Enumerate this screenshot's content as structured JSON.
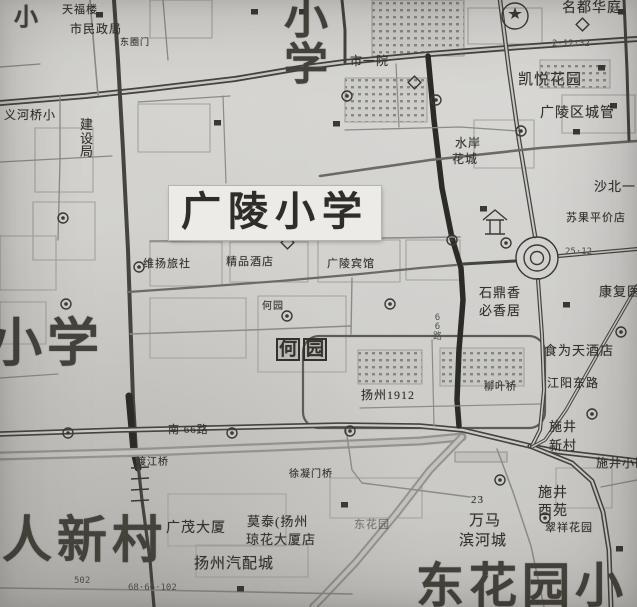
{
  "map": {
    "paper_color": "#d2d1cd",
    "ink_color": "#3b3a36",
    "labels": [
      {
        "text": "小学",
        "x": 284,
        "y": -4,
        "size": 44,
        "kind": "giant",
        "vertical": true
      },
      {
        "text": "广陵小学",
        "x": 169,
        "y": 186,
        "size": 40,
        "kind": "plate"
      },
      {
        "text": "小学",
        "x": -10,
        "y": 318,
        "size": 52,
        "kind": "giant"
      },
      {
        "text": "人新村",
        "x": 2,
        "y": 514,
        "size": 50,
        "kind": "giant"
      },
      {
        "text": "东花园小",
        "x": 416,
        "y": 562,
        "size": 48,
        "kind": "giant"
      },
      {
        "text": "小",
        "x": 14,
        "y": 6,
        "size": 24,
        "kind": "giant"
      },
      {
        "text": "天福楼",
        "x": 62,
        "y": 5,
        "size": 11
      },
      {
        "text": "市民政局",
        "x": 70,
        "y": 23,
        "size": 12
      },
      {
        "text": "东圈门",
        "x": 120,
        "y": 38,
        "size": 9
      },
      {
        "text": "市一院",
        "x": 350,
        "y": 55,
        "size": 12
      },
      {
        "text": "名都华庭",
        "x": 562,
        "y": 2,
        "size": 14
      },
      {
        "text": "凯悦花园",
        "x": 518,
        "y": 73,
        "size": 15
      },
      {
        "text": "广陵区城管",
        "x": 540,
        "y": 107,
        "size": 14
      },
      {
        "text": "水岸",
        "x": 455,
        "y": 137,
        "size": 12
      },
      {
        "text": "花城",
        "x": 452,
        "y": 153,
        "size": 12
      },
      {
        "text": "沙北一",
        "x": 594,
        "y": 180,
        "size": 13
      },
      {
        "text": "苏果平价店",
        "x": 566,
        "y": 213,
        "size": 11
      },
      {
        "text": "康复医院",
        "x": 599,
        "y": 285,
        "size": 13
      },
      {
        "text": "石鼎香",
        "x": 479,
        "y": 286,
        "size": 13
      },
      {
        "text": "必香居",
        "x": 479,
        "y": 304,
        "size": 13
      },
      {
        "text": "食为天酒店",
        "x": 544,
        "y": 344,
        "size": 13
      },
      {
        "text": "江阳东路",
        "x": 547,
        "y": 377,
        "size": 12
      },
      {
        "text": "柳叶桥",
        "x": 484,
        "y": 383,
        "size": 10
      },
      {
        "text": "施井",
        "x": 549,
        "y": 420,
        "size": 13
      },
      {
        "text": "新村",
        "x": 549,
        "y": 439,
        "size": 13
      },
      {
        "text": "施井小区",
        "x": 596,
        "y": 457,
        "size": 12
      },
      {
        "text": "施井",
        "x": 538,
        "y": 487,
        "size": 14
      },
      {
        "text": "西苑",
        "x": 538,
        "y": 505,
        "size": 14
      },
      {
        "text": "翠祥花园",
        "x": 545,
        "y": 523,
        "size": 11
      },
      {
        "text": "23",
        "x": 471,
        "y": 495,
        "size": 11
      },
      {
        "text": "万马",
        "x": 469,
        "y": 514,
        "size": 15
      },
      {
        "text": "滨河城",
        "x": 459,
        "y": 534,
        "size": 15
      },
      {
        "text": "东花园",
        "x": 354,
        "y": 520,
        "size": 11,
        "kind": "faint"
      },
      {
        "text": "广茂大厦",
        "x": 166,
        "y": 522,
        "size": 14
      },
      {
        "text": "莫泰(扬州",
        "x": 247,
        "y": 515,
        "size": 13
      },
      {
        "text": "琼花大厦店",
        "x": 246,
        "y": 533,
        "size": 13
      },
      {
        "text": "扬州汽配城",
        "x": 194,
        "y": 557,
        "size": 15
      },
      {
        "text": "渡江桥",
        "x": 136,
        "y": 458,
        "size": 10
      },
      {
        "text": "徐凝门桥",
        "x": 289,
        "y": 470,
        "size": 10
      },
      {
        "text": "南 66路",
        "x": 168,
        "y": 425,
        "size": 11
      },
      {
        "text": "扬州1912",
        "x": 361,
        "y": 389,
        "size": 12
      },
      {
        "text": "何园",
        "x": 276,
        "y": 338,
        "size": 18,
        "kind": "scenic"
      },
      {
        "text": "何园",
        "x": 262,
        "y": 302,
        "size": 10
      },
      {
        "text": "维扬旅社",
        "x": 143,
        "y": 259,
        "size": 11
      },
      {
        "text": "精品酒店",
        "x": 226,
        "y": 257,
        "size": 11
      },
      {
        "text": "广陵宾馆",
        "x": 327,
        "y": 259,
        "size": 11
      },
      {
        "text": "建设局",
        "x": 80,
        "y": 118,
        "size": 13,
        "vertical": true
      },
      {
        "text": "义河桥小",
        "x": 4,
        "y": 109,
        "size": 12
      },
      {
        "text": "25·12",
        "x": 565,
        "y": 248,
        "size": 9,
        "kind": "route"
      },
      {
        "text": "2·12·32",
        "x": 552,
        "y": 40,
        "size": 9,
        "kind": "route"
      },
      {
        "text": "66路",
        "x": 433,
        "y": 314,
        "size": 9,
        "kind": "route",
        "vertical": true
      },
      {
        "text": "68·66·102",
        "x": 128,
        "y": 584,
        "size": 9,
        "kind": "route"
      },
      {
        "text": "502",
        "x": 74,
        "y": 577,
        "size": 9,
        "kind": "route"
      }
    ],
    "roads": [
      {
        "d": "M0,103 L85,96 L150,89 L235,79 L300,68 L345,62 L430,54 L520,47 L637,39",
        "w": 6,
        "s": "dark"
      },
      {
        "d": "M0,103 L85,96 L150,89 L235,79 L300,68 L345,62 L430,54 L520,47 L637,39",
        "w": 2.4,
        "s": "lane"
      },
      {
        "d": "M114,0 L118,60 L123,150 L128,250 L131,340 L133,400 L136,452",
        "w": 4,
        "s": "dark"
      },
      {
        "d": "M129,396 L134,452 L138,468",
        "w": 7,
        "s": "heavy"
      },
      {
        "d": "M137,455 L142,500 L150,560 L154,607",
        "w": 3.2,
        "s": "dark"
      },
      {
        "d": "M0,456 L150,452 L300,446 L420,441 L462,437",
        "w": 9,
        "s": "canal"
      },
      {
        "d": "M0,456 L150,452 L300,446 L420,441 L462,437",
        "w": 4.5,
        "s": "canal2"
      },
      {
        "d": "M0,434 L120,430 L250,427 L340,425 L420,426 L463,430 L530,446 L560,452 L612,458 L637,461",
        "w": 5.5,
        "s": "dark"
      },
      {
        "d": "M0,434 L120,430 L250,427 L340,425 L420,426 L463,430 L530,446 L560,452 L612,458 L637,461",
        "w": 2.2,
        "s": "lane"
      },
      {
        "d": "M530,446 L572,463 L592,481 L603,512 L609,550 L611,607",
        "w": 5,
        "s": "dark"
      },
      {
        "d": "M530,446 L572,463 L592,481 L603,512 L609,550 L611,607",
        "w": 2,
        "s": "lane"
      },
      {
        "d": "M462,437 L430,470 L396,514 L356,562 L322,598 L313,607",
        "w": 8,
        "s": "canal"
      },
      {
        "d": "M462,437 L430,470 L396,514 L356,562 L322,598 L313,607",
        "w": 4,
        "s": "canal2"
      },
      {
        "d": "M497,449 L513,492 L531,546 L544,607",
        "w": 1.5,
        "s": "min"
      },
      {
        "d": "M428,56 L434,120 L442,188 L452,238 L461,268 L463,300 L459,350 L457,400 L459,426",
        "w": 5.5,
        "s": "heavy"
      },
      {
        "d": "M128,292 L200,287 L280,281 L360,274 L420,268 L456,265",
        "w": 2.2,
        "s": "med"
      },
      {
        "d": "M463,264 L515,261",
        "w": 3,
        "s": "dark"
      },
      {
        "d": "M559,256 L637,249",
        "w": 4,
        "s": "dark"
      },
      {
        "d": "M559,256 L637,249",
        "w": 1.6,
        "s": "lane"
      },
      {
        "d": "M500,0 L509,70 L519,140 L529,200 L535,236",
        "w": 4.5,
        "s": "dark"
      },
      {
        "d": "M500,0 L509,70 L519,140 L529,200 L535,236",
        "w": 2,
        "s": "lane"
      },
      {
        "d": "M538,280 L542,335 L544,390 L540,430 L532,446",
        "w": 4,
        "s": "dark"
      },
      {
        "d": "M538,280 L542,335 L544,390 L540,430 L532,446",
        "w": 1.6,
        "s": "lane"
      },
      {
        "d": "M637,286 L600,350 L566,410 L545,440 L532,447",
        "w": 3.5,
        "s": "dark"
      },
      {
        "d": "M637,286 L600,350 L566,410 L545,440 L532,447",
        "w": 1.5,
        "s": "lane"
      },
      {
        "d": "M320,176 L430,160 L540,148 L637,141",
        "w": 2.6,
        "s": "med"
      },
      {
        "d": "M624,0 L627,70 L629,140",
        "w": 3,
        "s": "dark"
      },
      {
        "d": "M342,0 L345,30 L345,62",
        "w": 3,
        "s": "dark"
      },
      {
        "d": "M60,95 L60,160 L58,240",
        "w": 1.3,
        "s": "min"
      },
      {
        "d": "M0,162 L112,156",
        "w": 1.3,
        "s": "min"
      },
      {
        "d": "M138,102 L230,96",
        "w": 1.3,
        "s": "min"
      },
      {
        "d": "M150,241 L460,237",
        "w": 1.6,
        "s": "min"
      },
      {
        "d": "M345,130 L460,127 L518,131",
        "w": 1.3,
        "s": "min"
      },
      {
        "d": "M396,64 L399,127",
        "w": 1.2,
        "s": "min"
      },
      {
        "d": "M223,96 L226,183",
        "w": 1.2,
        "s": "min"
      },
      {
        "d": "M130,334 L250,330 L351,326",
        "w": 1.5,
        "s": "min"
      },
      {
        "d": "M352,278 L351,334",
        "w": 1.4,
        "s": "min"
      },
      {
        "d": "M0,378 L58,374",
        "w": 1.2,
        "s": "min"
      },
      {
        "d": "M0,588 L150,590 L352,594",
        "w": 1.6,
        "s": "min"
      },
      {
        "d": "M346,429 L352,470 L362,483 L432,492 L470,497",
        "w": 1.4,
        "s": "min"
      },
      {
        "d": "M90,0 L95,60 L98,95",
        "w": 1.6,
        "s": "min"
      },
      {
        "d": "M163,0 L168,60",
        "w": 1.3,
        "s": "min"
      },
      {
        "d": "M0,67 L40,64",
        "w": 1.2,
        "s": "min"
      },
      {
        "d": "M601,487 L637,480",
        "w": 1.4,
        "s": "min"
      },
      {
        "d": "M360,408 L540,404",
        "w": 1.2,
        "s": "min"
      },
      {
        "d": "M432,340 L434,426",
        "w": 1.2,
        "s": "min"
      }
    ],
    "blocks": [
      {
        "x": 35,
        "y": 128,
        "w": 58,
        "h": 64
      },
      {
        "x": 33,
        "y": 202,
        "w": 62,
        "h": 58
      },
      {
        "x": 0,
        "y": 236,
        "w": 56,
        "h": 54
      },
      {
        "x": 138,
        "y": 104,
        "w": 72,
        "h": 48
      },
      {
        "x": 150,
        "y": 0,
        "w": 62,
        "h": 38
      },
      {
        "x": 372,
        "y": 0,
        "w": 92,
        "h": 56,
        "f": "dots"
      },
      {
        "x": 468,
        "y": 8,
        "w": 74,
        "h": 36
      },
      {
        "x": 345,
        "y": 78,
        "w": 82,
        "h": 44,
        "f": "dots"
      },
      {
        "x": 562,
        "y": 95,
        "w": 73,
        "h": 38
      },
      {
        "x": 150,
        "y": 242,
        "w": 72,
        "h": 44
      },
      {
        "x": 230,
        "y": 242,
        "w": 78,
        "h": 40
      },
      {
        "x": 318,
        "y": 240,
        "w": 82,
        "h": 42
      },
      {
        "x": 406,
        "y": 240,
        "w": 54,
        "h": 40
      },
      {
        "x": 258,
        "y": 296,
        "w": 88,
        "h": 76
      },
      {
        "x": 150,
        "y": 298,
        "w": 96,
        "h": 60
      },
      {
        "x": 0,
        "y": 302,
        "w": 46,
        "h": 42
      },
      {
        "x": 303,
        "y": 336,
        "w": 242,
        "h": 92,
        "rx": 16,
        "f": "loop"
      },
      {
        "x": 358,
        "y": 350,
        "w": 64,
        "h": 34,
        "f": "dots"
      },
      {
        "x": 440,
        "y": 348,
        "w": 84,
        "h": 38,
        "f": "dots"
      },
      {
        "x": 168,
        "y": 494,
        "w": 118,
        "h": 52
      },
      {
        "x": 330,
        "y": 478,
        "w": 92,
        "h": 40
      },
      {
        "x": 556,
        "y": 468,
        "w": 56,
        "h": 40
      },
      {
        "x": 196,
        "y": 545,
        "w": 112,
        "h": 32
      },
      {
        "x": 474,
        "y": 120,
        "w": 60,
        "h": 48
      },
      {
        "x": 540,
        "y": 60,
        "w": 70,
        "h": 28,
        "f": "dots"
      },
      {
        "x": 455,
        "y": 452,
        "w": 52,
        "h": 10,
        "f": "shade"
      }
    ],
    "icons": [
      {
        "type": "roundabout",
        "x": 537,
        "y": 258
      },
      {
        "type": "pavilion",
        "x": 483,
        "y": 210
      },
      {
        "type": "emblem",
        "x": 502,
        "y": 3
      },
      {
        "type": "bridge",
        "x": 133,
        "y": 468
      },
      {
        "type": "bus-stop",
        "x": 63,
        "y": 218
      },
      {
        "type": "bus-stop",
        "x": 303,
        "y": 214
      },
      {
        "type": "bus-stop",
        "x": 139,
        "y": 267
      },
      {
        "type": "bus-stop",
        "x": 66,
        "y": 304
      },
      {
        "type": "bus-stop",
        "x": 390,
        "y": 304
      },
      {
        "type": "bus-stop",
        "x": 347,
        "y": 96
      },
      {
        "type": "bus-stop",
        "x": 521,
        "y": 131
      },
      {
        "type": "bus-stop",
        "x": 452,
        "y": 240
      },
      {
        "type": "bus-stop",
        "x": 506,
        "y": 243
      },
      {
        "type": "bus-stop",
        "x": 350,
        "y": 431
      },
      {
        "type": "bus-stop",
        "x": 232,
        "y": 433
      },
      {
        "type": "bus-stop",
        "x": 68,
        "y": 433
      },
      {
        "type": "bus-stop",
        "x": 500,
        "y": 480
      },
      {
        "type": "bus-stop",
        "x": 592,
        "y": 414
      },
      {
        "type": "bus-stop",
        "x": 621,
        "y": 332
      },
      {
        "type": "bus-stop",
        "x": 436,
        "y": 100
      },
      {
        "type": "bus-stop",
        "x": 287,
        "y": 316
      },
      {
        "type": "bus-stop",
        "x": 545,
        "y": 518
      },
      {
        "type": "building",
        "x": 96,
        "y": 12
      },
      {
        "type": "building",
        "x": 251,
        "y": 9
      },
      {
        "type": "building",
        "x": 299,
        "y": 9
      },
      {
        "type": "building",
        "x": 618,
        "y": 9
      },
      {
        "type": "building",
        "x": 333,
        "y": 121
      },
      {
        "type": "building",
        "x": 480,
        "y": 206
      },
      {
        "type": "building",
        "x": 563,
        "y": 302
      },
      {
        "type": "building",
        "x": 616,
        "y": 546
      },
      {
        "type": "building",
        "x": 341,
        "y": 502
      },
      {
        "type": "building",
        "x": 237,
        "y": 586
      },
      {
        "type": "building",
        "x": 598,
        "y": 65
      },
      {
        "type": "building",
        "x": 214,
        "y": 120
      },
      {
        "type": "building",
        "x": 573,
        "y": 129
      },
      {
        "type": "building",
        "x": 610,
        "y": 103
      },
      {
        "type": "diamond",
        "x": 410,
        "y": 78
      },
      {
        "type": "diamond",
        "x": 578,
        "y": 20
      },
      {
        "type": "diamond",
        "x": 283,
        "y": 238
      }
    ]
  }
}
